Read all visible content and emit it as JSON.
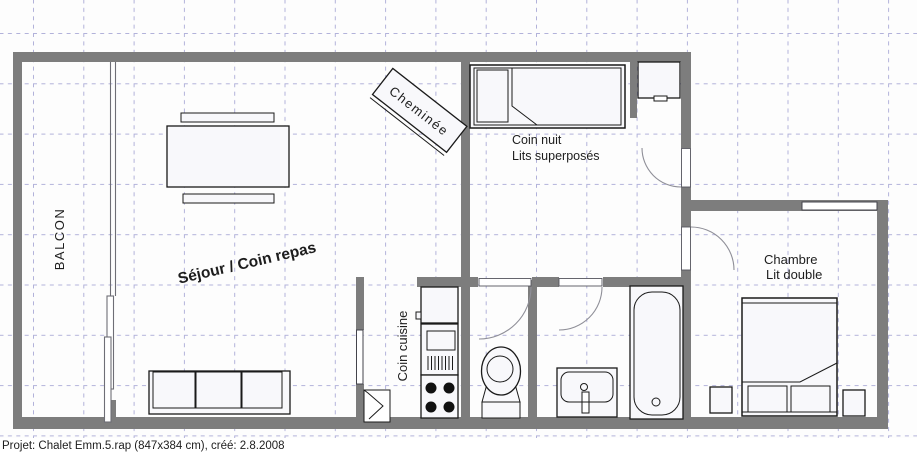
{
  "plan": {
    "labels": {
      "balcony": "BALCON",
      "living": "Séjour / Coin repas",
      "fireplace": "Cheminée",
      "sleeping_corner_line1": "Coin nuit",
      "sleeping_corner_line2": "Lits superposés",
      "kitchen": "Coin cuisine",
      "bedroom_line1": "Chambre",
      "bedroom_line2": "Lit double"
    },
    "status_bar": {
      "text": "Projet: Chalet Emm.5.rap (847x384 cm), créé: 2.8.2008"
    },
    "colors": {
      "wall": "#7d7d7d",
      "grid": "#b2b2da",
      "furniture_outline": "#1a1a1a",
      "furniture_fill": "#f8f8fb",
      "door_arc": "#8f8f98",
      "label_text": "#1d1d1d"
    }
  }
}
